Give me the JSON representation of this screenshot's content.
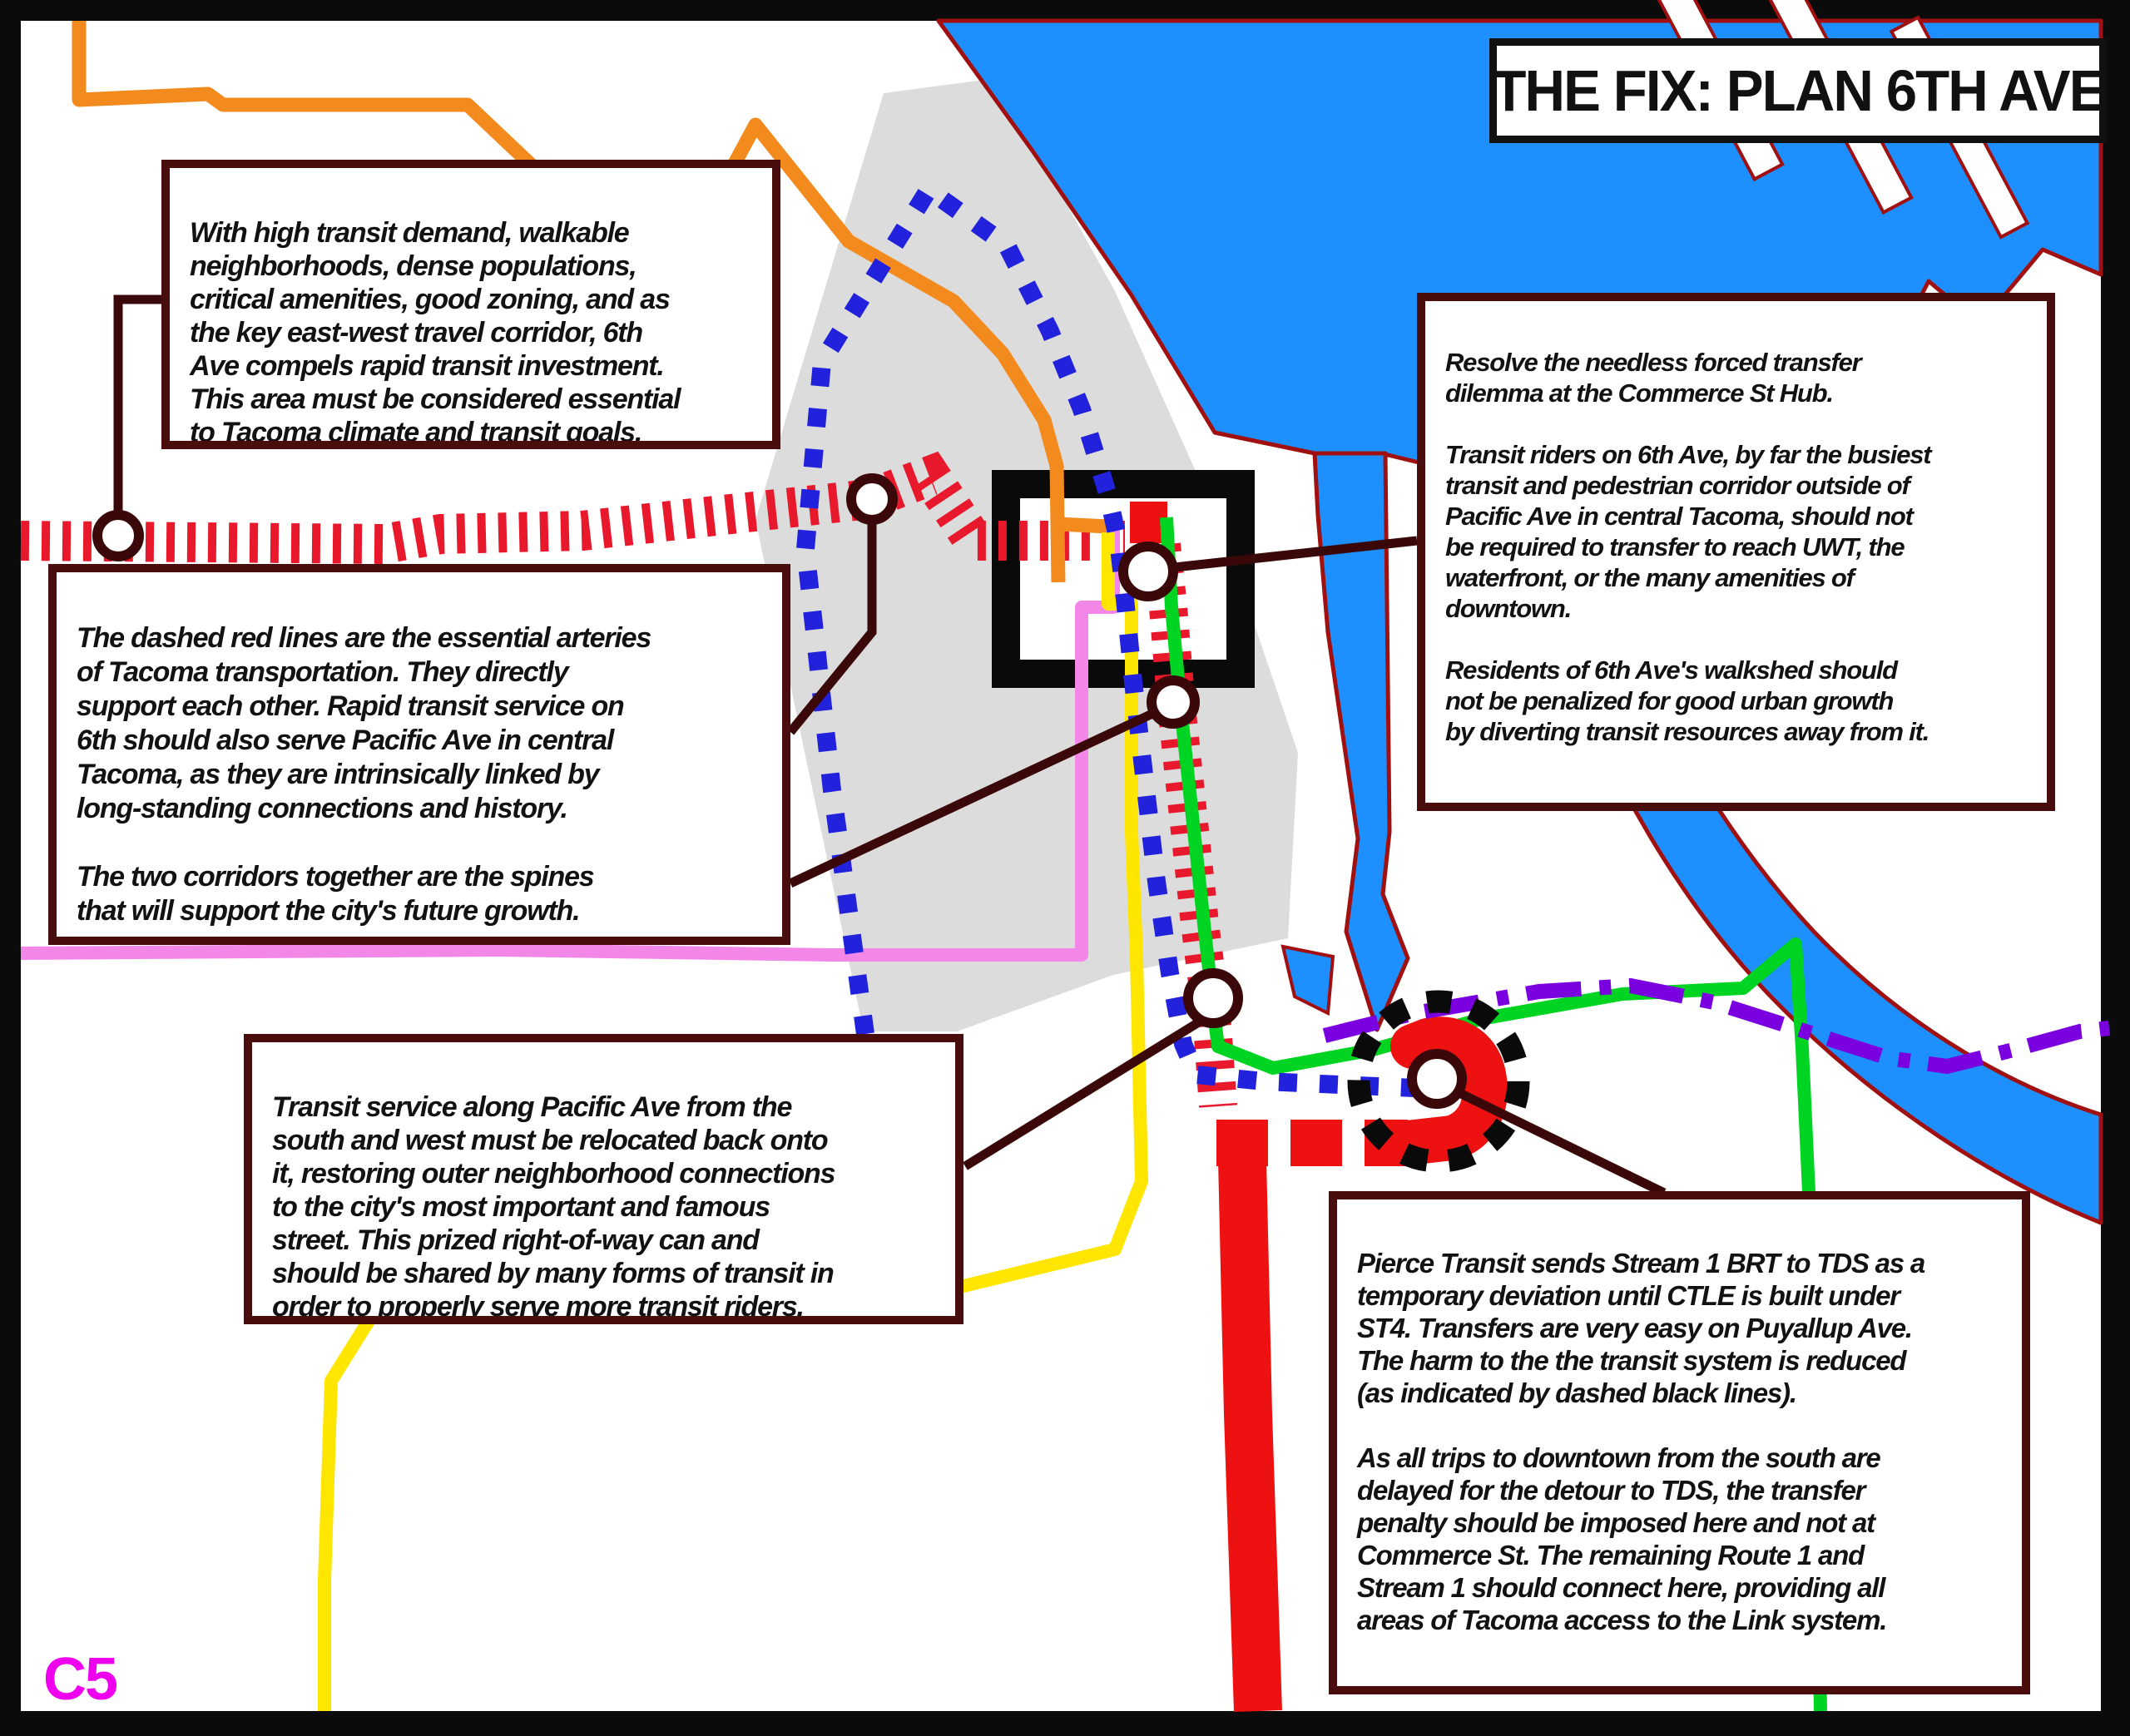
{
  "title": "THE FIX: PLAN 6TH AVE",
  "page_label": "C5",
  "annotations": {
    "top_left": "With high transit demand, walkable\nneighborhoods, dense populations,\ncritical amenities, good zoning, and as\nthe key east-west travel corridor, 6th\nAve compels rapid transit investment.\nThis area must be considered essential\nto Tacoma climate and transit goals.",
    "mid_left": "The dashed red lines are the essential arteries\nof Tacoma transportation. They directly\nsupport each other. Rapid transit service on\n6th should also serve Pacific Ave in central\nTacoma, as they are intrinsically linked by\nlong-standing connections and history.\n\nThe two corridors together are the spines\nthat will support the city's future growth.",
    "right": "Resolve the needless forced transfer\ndilemma at the Commerce St Hub.\n\nTransit riders on 6th Ave, by far the busiest\ntransit and pedestrian corridor outside of\nPacific Ave in central Tacoma, should not\nbe required to transfer to reach UWT, the\nwaterfront, or the many amenities of\ndowntown.\n\nResidents of 6th Ave's walkshed should\nnot be penalized for good urban growth\nby diverting transit resources away from it.",
    "bottom_left": "Transit service along Pacific Ave from the\nsouth and west must be relocated back onto\nit, restoring outer neighborhood connections\nto the city's most important and famous\nstreet. This prized right-of-way can and\nshould be shared by many forms of transit in\norder to properly serve more transit riders.",
    "bottom_right": "Pierce Transit sends Stream 1 BRT to TDS as a\ntemporary deviation until CTLE is built under\nST4. Transfers are very easy on Puyallup Ave.\nThe harm to the the transit system is reduced\n(as indicated by dashed black lines).\n\nAs all trips to downtown from the south are\ndelayed for the detour to TDS, the transfer\npenalty should be imposed here and not at\nCommerce St. The remaining Route 1 and\nStream 1 should connect here, providing all\nareas of Tacoma access to the Link system."
  },
  "colors": {
    "frame_black": "#0b0b0b",
    "map_white": "#ffffff",
    "downtown_gray": "#dcdcdc",
    "water_blue": "#1e8fff",
    "water_outline": "#a01010",
    "dashed_red": "#e8192c",
    "bright_red": "#ee1111",
    "orange_route": "#f28a1d",
    "blue_dotted": "#2222dd",
    "pink_route": "#f387e8",
    "yellow_route": "#ffe600",
    "green_route": "#00d422",
    "purple_route": "#7a00e0",
    "hub_black": "#0a0a0a",
    "connector_maroon": "#3a0808",
    "box_border": "#4a0d0d",
    "label_magenta": "#ee00ee"
  }
}
